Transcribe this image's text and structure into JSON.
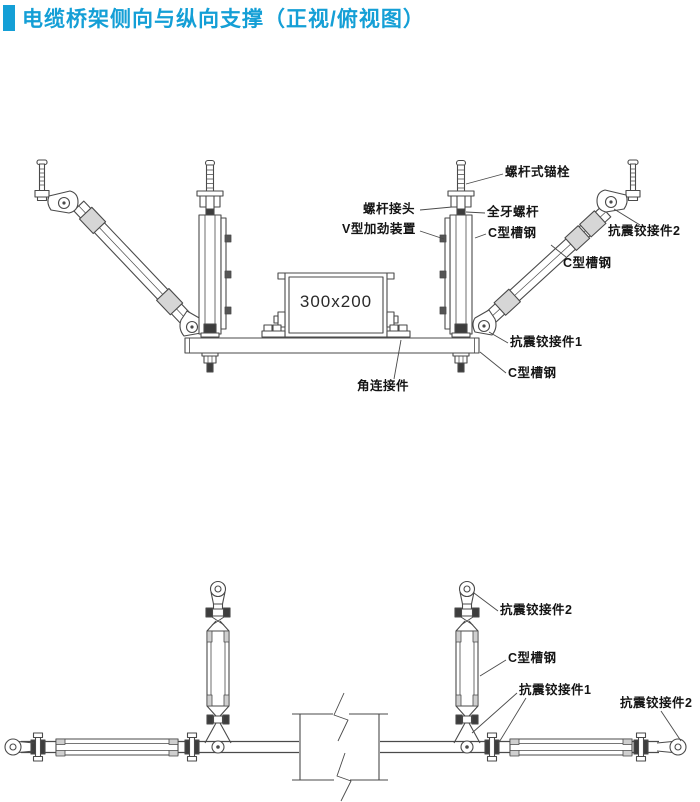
{
  "title": "电缆桥架侧向与纵向支撑（正视/俯视图）",
  "colors": {
    "accent": "#149fd6",
    "line": "#4a4a4a"
  },
  "front_view": {
    "tray_size_label": "300x200",
    "labels": [
      {
        "id": "screw-anchor-bolt",
        "text": "螺杆式锚栓"
      },
      {
        "id": "rod-coupler",
        "text": "螺杆接头"
      },
      {
        "id": "full-thread-rod",
        "text": "全牙螺杆"
      },
      {
        "id": "v-stiffener-device",
        "text": "V型加劲装置"
      },
      {
        "id": "c-channel-vertical",
        "text": "C型槽钢"
      },
      {
        "id": "seismic-hinge-2",
        "text": "抗震铰接件2"
      },
      {
        "id": "c-channel-diagonal",
        "text": "C型槽钢"
      },
      {
        "id": "seismic-hinge-1",
        "text": "抗震铰接件1"
      },
      {
        "id": "c-channel-beam",
        "text": "C型槽钢"
      },
      {
        "id": "angle-connector",
        "text": "角连接件"
      }
    ]
  },
  "top_view": {
    "labels": [
      {
        "id": "seismic-hinge-2-top",
        "text": "抗震铰接件2"
      },
      {
        "id": "c-channel",
        "text": "C型槽钢"
      },
      {
        "id": "seismic-hinge-1",
        "text": "抗震铰接件1"
      },
      {
        "id": "seismic-hinge-2-right",
        "text": "抗震铰接件2"
      }
    ]
  }
}
